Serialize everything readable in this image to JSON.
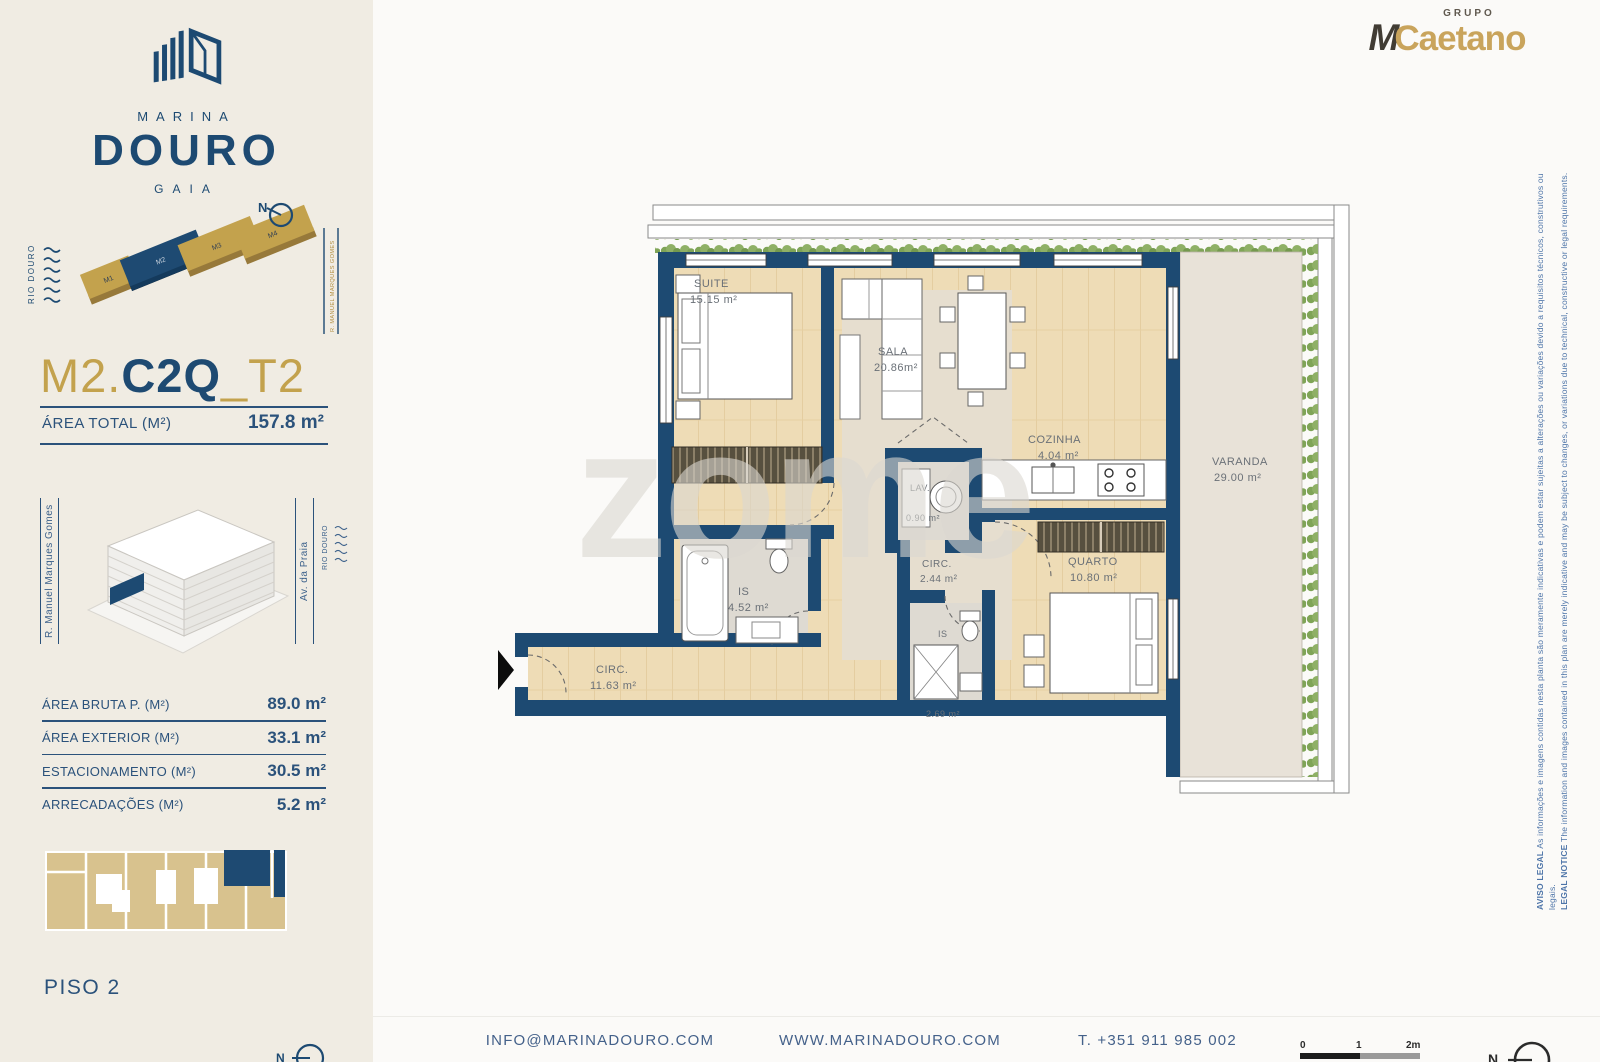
{
  "brand": {
    "marina": "MARINA",
    "douro": "DOURO",
    "gaia": "GAIA"
  },
  "partner": {
    "grupo": "GRUPO",
    "m": "M",
    "caetano": "Caetano"
  },
  "site_map": {
    "river": "RIO DOURO",
    "street": "R. MANUEL MARQUES GOMES",
    "north": "N",
    "blocks": [
      {
        "label": "M1"
      },
      {
        "label": "M2"
      },
      {
        "label": "M3"
      },
      {
        "label": "M4"
      }
    ]
  },
  "unit": {
    "prefix": "M2.",
    "main": "C2Q",
    "suffix": "_T2",
    "area_total_label": "ÁREA TOTAL  (M²)",
    "area_total_value": "157.8 m²"
  },
  "building": {
    "street_left": "R. Manuel Marques Gomes",
    "street_right": "Av. da Praia",
    "river": "RIO DOURO"
  },
  "areas": [
    {
      "label": "ÁREA BRUTA P.  (M²)",
      "value": "89.0 m²"
    },
    {
      "label": "ÁREA EXTERIOR (M²)",
      "value": "33.1 m²"
    },
    {
      "label": "ESTACIONAMENTO (M²)",
      "value": "30.5 m²"
    },
    {
      "label": "ARRECADAÇÕES (M²)",
      "value": "5.2 m²"
    }
  ],
  "floor_label": "PISO 2",
  "plan": {
    "watermark": "zome",
    "rooms": [
      {
        "name": "SUITE",
        "area": "15.15 m²"
      },
      {
        "name": "SALA",
        "area": "20.86m²"
      },
      {
        "name": "COZINHA",
        "area": "4.04 m²"
      },
      {
        "name": "VARANDA",
        "area": "29.00 m²"
      },
      {
        "name": "LAV.",
        "area": "0.90 m²"
      },
      {
        "name": "IS",
        "area": "4.52 m²"
      },
      {
        "name": "CIRC.",
        "area": "2.44 m²"
      },
      {
        "name": "QUARTO",
        "area": "10.80 m²"
      },
      {
        "name": "IS",
        "area": "2.69 m²"
      },
      {
        "name": "CIRC.",
        "area": "11.63 m²"
      }
    ]
  },
  "footer": {
    "email": "INFO@MARINADOURO.COM",
    "website": "WWW.MARINADOURO.COM",
    "phone": "T. +351 911 985 002",
    "scale": [
      "0",
      "1",
      "2m"
    ],
    "north": "N"
  },
  "sidebar_compass": {
    "north": "N"
  },
  "legal": {
    "pt_label": "AVISO LEGAL",
    "pt_text": " As informações e imagens contidas nesta planta são meramente indicativas e podem estar sujeitas a alterações ou variações devido a requisitos técnicos, construtivos ou legais.",
    "en_label": "LEGAL NOTICE",
    "en_text": " The information and images contained in this plan are merely indicative and may be subject to changes, or variations due to technical, constructive or legal requirements."
  },
  "colors": {
    "navy": "#1d4a72",
    "gold": "#c3a24d",
    "beige": "#f0ece3"
  }
}
